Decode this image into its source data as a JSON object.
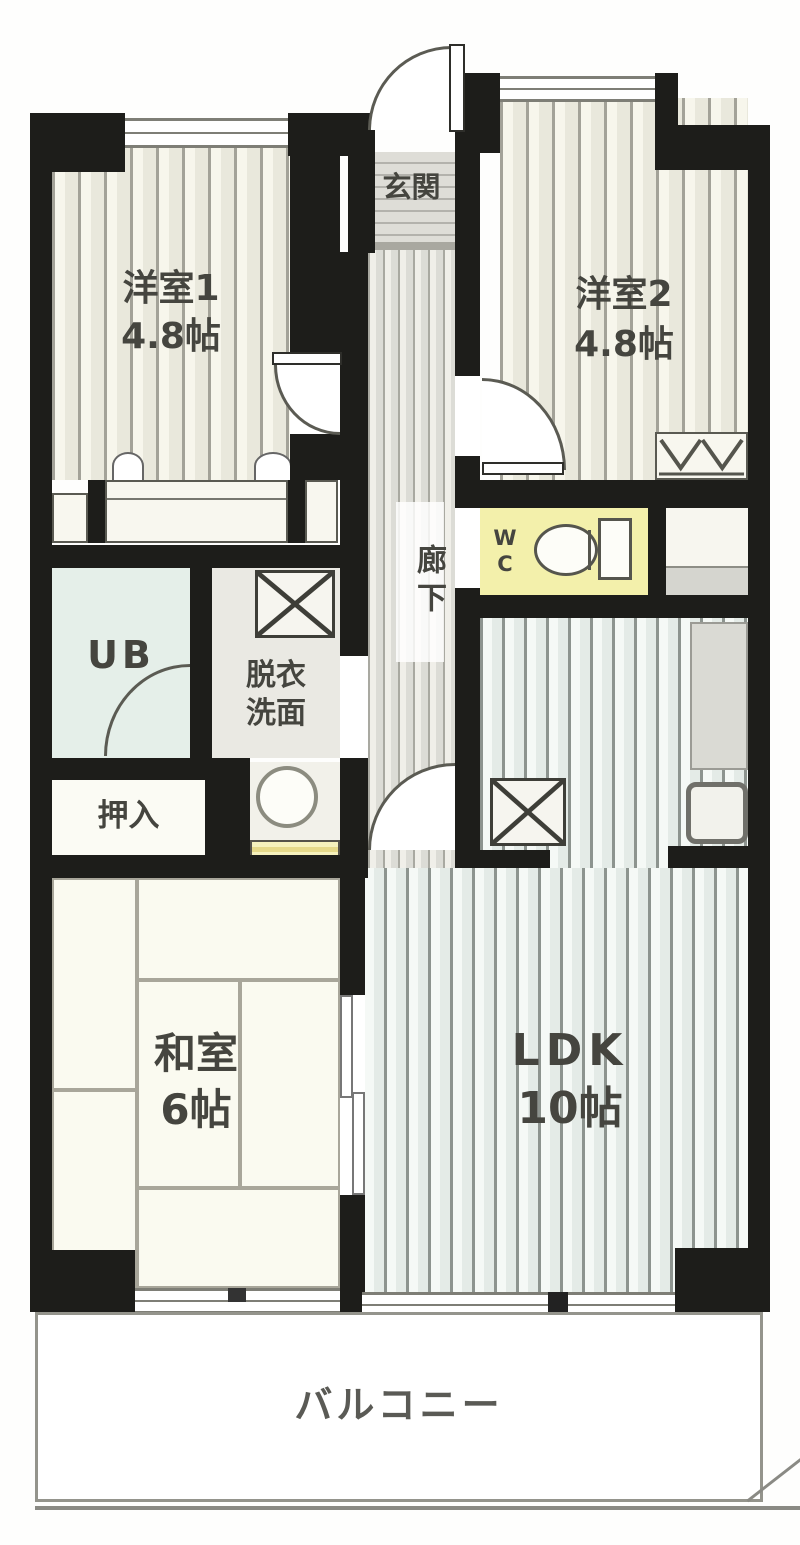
{
  "plan": {
    "type": "apartment-floor-plan",
    "rooms": {
      "genkan": {
        "label": "玄関"
      },
      "rouka": {
        "label": "廊下"
      },
      "yoshitsu1": {
        "name": "洋室1",
        "size": "4.8帖"
      },
      "yoshitsu2": {
        "name": "洋室2",
        "size": "4.8帖"
      },
      "wc": {
        "label": "WC"
      },
      "ub": {
        "label": "UB"
      },
      "senmen": {
        "line1": "脱衣",
        "line2": "洗面"
      },
      "oshiire": {
        "label": "押入"
      },
      "washitsu": {
        "name": "和室",
        "size": "6帖"
      },
      "ldk": {
        "name": "LDK",
        "size": "10帖"
      },
      "balcony": {
        "label": "バルコニー"
      }
    },
    "colors": {
      "wall": "#1d1d1a",
      "text": "#45453f",
      "wc_floor": "#f3f0ab",
      "ub_floor": "#e5efe9",
      "counter_yellow": "#f6f1bd"
    }
  }
}
